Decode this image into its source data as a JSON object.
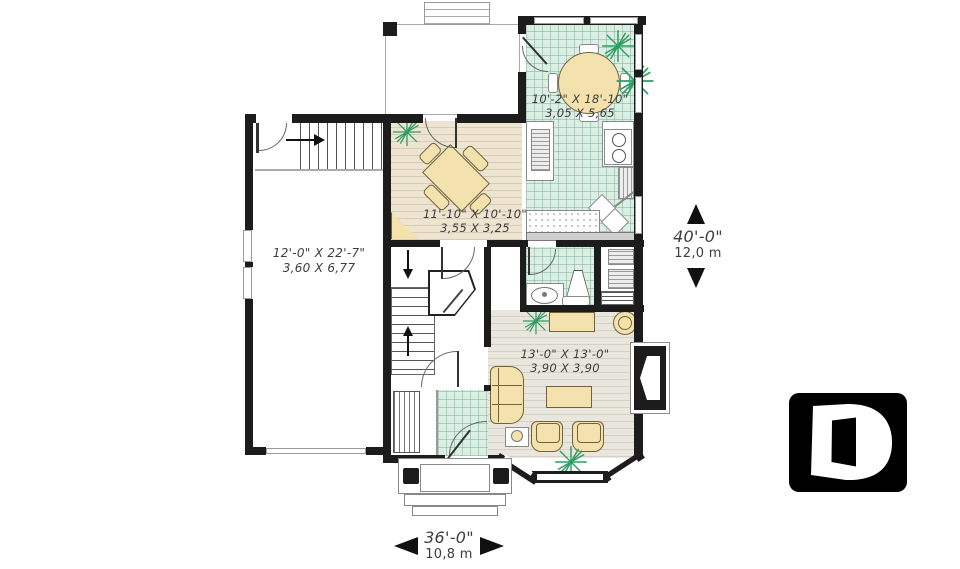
{
  "rooms": {
    "breakfast": {
      "imperial": "10'-2\" X 18'-10\"",
      "metric": "3,05 X 5,65"
    },
    "dining": {
      "imperial": "11'-10\" X 10'-10\"",
      "metric": "3,55 X 3,25"
    },
    "garage": {
      "imperial": "12'-0\" X 22'-7\"",
      "metric": "3,60 X 6,77"
    },
    "living": {
      "imperial": "13'-0\" X 13'-0\"",
      "metric": "3,90 X 3,90"
    }
  },
  "dimensions": {
    "depth_imperial": "40'-0\"",
    "depth_metric": "12,0 m",
    "width_imperial": "36'-0\"",
    "width_metric": "10,8 m"
  },
  "logo": {
    "letter": "D"
  },
  "colors": {
    "wall": "#1c1c1c",
    "tile": "#dcefe4",
    "wood": "#e9dfcc",
    "living_floor": "#e7e4da",
    "furniture": "#f3e1ae",
    "plant": "#2f9e63",
    "text": "#3d3d3d",
    "logo_bg": "#000000"
  }
}
